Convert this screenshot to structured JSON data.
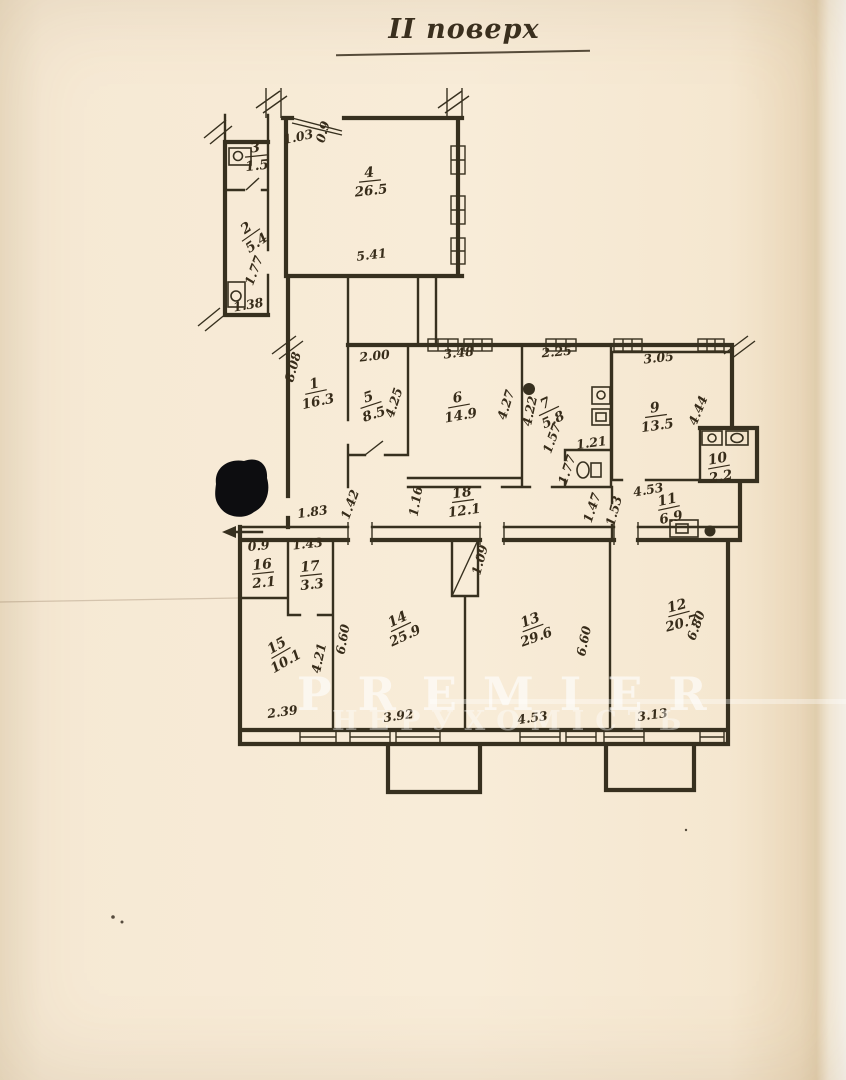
{
  "document": {
    "title": "ІІ поверх"
  },
  "watermark": {
    "line1": "PREMIER",
    "line2": "НЕРУХОМІСТЬ"
  },
  "colors": {
    "paper": "#f8ecd8",
    "ink": "#37301f",
    "blot": "#0d0d10",
    "watermark_text": "#ffffff"
  },
  "rooms": [
    {
      "number": "3",
      "area": "1.5",
      "x": 256,
      "y": 156,
      "r": -6
    },
    {
      "number": "2",
      "area": "5.4",
      "x": 251,
      "y": 235,
      "r": -35
    },
    {
      "number": "4",
      "area": "26.5",
      "x": 370,
      "y": 181,
      "r": -6
    },
    {
      "number": "1",
      "area": "16.3",
      "x": 316,
      "y": 392,
      "r": -12
    },
    {
      "number": "5",
      "area": "8.5",
      "x": 371,
      "y": 405,
      "r": -18
    },
    {
      "number": "6",
      "area": "14.9",
      "x": 459,
      "y": 406,
      "r": -10
    },
    {
      "number": "7",
      "area": "5.8",
      "x": 549,
      "y": 411,
      "r": -25
    },
    {
      "number": "9",
      "area": "13.5",
      "x": 656,
      "y": 416,
      "r": -8
    },
    {
      "number": "10",
      "area": "2.2",
      "x": 719,
      "y": 467,
      "r": -10
    },
    {
      "number": "18",
      "area": "12.1",
      "x": 463,
      "y": 501,
      "r": -8
    },
    {
      "number": "11",
      "area": "6.9",
      "x": 669,
      "y": 508,
      "r": -12
    },
    {
      "number": "16",
      "area": "2.1",
      "x": 263,
      "y": 573,
      "r": -6
    },
    {
      "number": "17",
      "area": "3.3",
      "x": 311,
      "y": 575,
      "r": -6
    },
    {
      "number": "15",
      "area": "10.1",
      "x": 281,
      "y": 653,
      "r": -30
    },
    {
      "number": "14",
      "area": "25.9",
      "x": 401,
      "y": 627,
      "r": -25
    },
    {
      "number": "13",
      "area": "29.6",
      "x": 533,
      "y": 628,
      "r": -20
    },
    {
      "number": "12",
      "area": "20.7",
      "x": 679,
      "y": 614,
      "r": -15
    }
  ],
  "dimensions": [
    {
      "text": "1.03",
      "x": 299,
      "y": 141,
      "r": -12
    },
    {
      "text": "0.9",
      "x": 327,
      "y": 133,
      "r": -75
    },
    {
      "text": "5.41",
      "x": 372,
      "y": 259,
      "r": -7
    },
    {
      "text": "1.38",
      "x": 249,
      "y": 309,
      "r": -10
    },
    {
      "text": "1.77",
      "x": 258,
      "y": 272,
      "r": -70
    },
    {
      "text": "8.08",
      "x": 297,
      "y": 368,
      "r": -75
    },
    {
      "text": "2.00",
      "x": 375,
      "y": 360,
      "r": -6
    },
    {
      "text": "4.25",
      "x": 398,
      "y": 404,
      "r": -72
    },
    {
      "text": "3.48",
      "x": 459,
      "y": 357,
      "r": -6
    },
    {
      "text": "4.27",
      "x": 510,
      "y": 406,
      "r": -73
    },
    {
      "text": "2.25",
      "x": 557,
      "y": 356,
      "r": -5
    },
    {
      "text": "4.22",
      "x": 534,
      "y": 412,
      "r": -78
    },
    {
      "text": "1.57",
      "x": 556,
      "y": 440,
      "r": -70
    },
    {
      "text": "1.21",
      "x": 592,
      "y": 447,
      "r": -8
    },
    {
      "text": "1.77",
      "x": 571,
      "y": 471,
      "r": -72
    },
    {
      "text": "3.05",
      "x": 659,
      "y": 362,
      "r": -6
    },
    {
      "text": "4.44",
      "x": 702,
      "y": 412,
      "r": -68
    },
    {
      "text": "1.16",
      "x": 420,
      "y": 502,
      "r": -80
    },
    {
      "text": "1.47",
      "x": 596,
      "y": 509,
      "r": -72
    },
    {
      "text": "1.53",
      "x": 618,
      "y": 512,
      "r": -75
    },
    {
      "text": "4.53",
      "x": 649,
      "y": 494,
      "r": -10
    },
    {
      "text": "1.83",
      "x": 313,
      "y": 516,
      "r": -8
    },
    {
      "text": "1.42",
      "x": 354,
      "y": 506,
      "r": -70
    },
    {
      "text": "0.9",
      "x": 259,
      "y": 550,
      "r": -5
    },
    {
      "text": "1.43",
      "x": 308,
      "y": 548,
      "r": -6
    },
    {
      "text": "2.39",
      "x": 283,
      "y": 716,
      "r": -8
    },
    {
      "text": "4.21",
      "x": 323,
      "y": 659,
      "r": -78
    },
    {
      "text": "6.60",
      "x": 347,
      "y": 640,
      "r": -80
    },
    {
      "text": "3.92",
      "x": 399,
      "y": 720,
      "r": -8
    },
    {
      "text": "1.09",
      "x": 484,
      "y": 561,
      "r": -75
    },
    {
      "text": "6.60",
      "x": 588,
      "y": 642,
      "r": -78
    },
    {
      "text": "4.53",
      "x": 533,
      "y": 722,
      "r": -8
    },
    {
      "text": "6.80",
      "x": 700,
      "y": 627,
      "r": -70
    },
    {
      "text": "3.13",
      "x": 653,
      "y": 719,
      "r": -8
    }
  ]
}
